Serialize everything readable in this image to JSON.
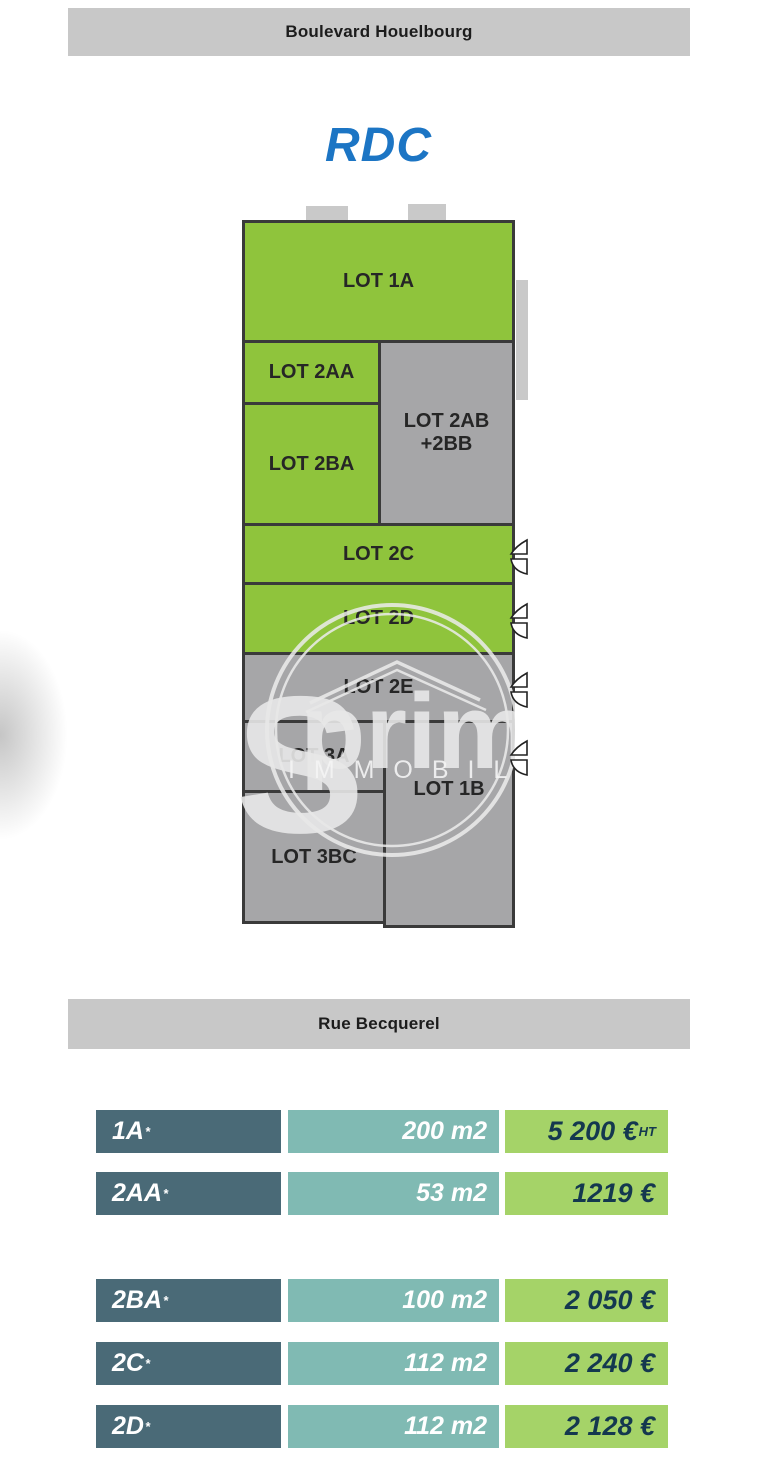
{
  "streets": {
    "top": "Boulevard Houelbourg",
    "bottom": "Rue Becquerel"
  },
  "floor_title": "RDC",
  "colors": {
    "street_bar_bg": "#c8c8c8",
    "title_blue": "#1c75c4",
    "lot_green": "#8fc43c",
    "lot_gray": "#a6a6a8",
    "plan_border": "#3a3a3a",
    "tab_gray": "#c9c9c9",
    "row_label_bg": "#4a6a77",
    "row_area_bg": "#80bab3",
    "row_price_bg": "#a5d368",
    "row_price_text": "#14384f"
  },
  "plan": {
    "lots": [
      {
        "id": "1A",
        "label": "LOT 1A",
        "label2": "",
        "fill": "green"
      },
      {
        "id": "2AA",
        "label": "LOT 2AA",
        "label2": "",
        "fill": "green"
      },
      {
        "id": "2BA",
        "label": "LOT 2BA",
        "label2": "",
        "fill": "green"
      },
      {
        "id": "2AB-2BB",
        "label": "LOT 2AB",
        "label2": "+2BB",
        "fill": "gray"
      },
      {
        "id": "2C",
        "label": "LOT 2C",
        "label2": "",
        "fill": "green"
      },
      {
        "id": "2D",
        "label": "LOT 2D",
        "label2": "",
        "fill": "green"
      },
      {
        "id": "2E",
        "label": "LOT 2E",
        "label2": "",
        "fill": "gray"
      },
      {
        "id": "3A",
        "label": "LOT 3A",
        "label2": "",
        "fill": "gray"
      },
      {
        "id": "3BC",
        "label": "LOT 3BC",
        "label2": "",
        "fill": "gray"
      },
      {
        "id": "1B",
        "label": "LOT 1B",
        "label2": "",
        "fill": "gray"
      }
    ]
  },
  "watermark": {
    "big_letter": "S",
    "word": "primtou",
    "subtitle": "I M M O B I L I E R"
  },
  "table": {
    "rows": [
      {
        "lot": "1A",
        "sup": "*",
        "area": "200 m2",
        "price": "5 200 €",
        "price_sup": "HT"
      },
      {
        "lot": "2AA",
        "sup": "*",
        "area": "53 m2",
        "price": "1219 €",
        "price_sup": ""
      },
      {
        "lot": "2BA",
        "sup": "*",
        "area": "100 m2",
        "price": "2 050 €",
        "price_sup": ""
      },
      {
        "lot": "2C",
        "sup": "*",
        "area": "112 m2",
        "price": "2 240 €",
        "price_sup": ""
      },
      {
        "lot": "2D",
        "sup": "*",
        "area": "112 m2",
        "price": "2 128 €",
        "price_sup": ""
      }
    ]
  }
}
